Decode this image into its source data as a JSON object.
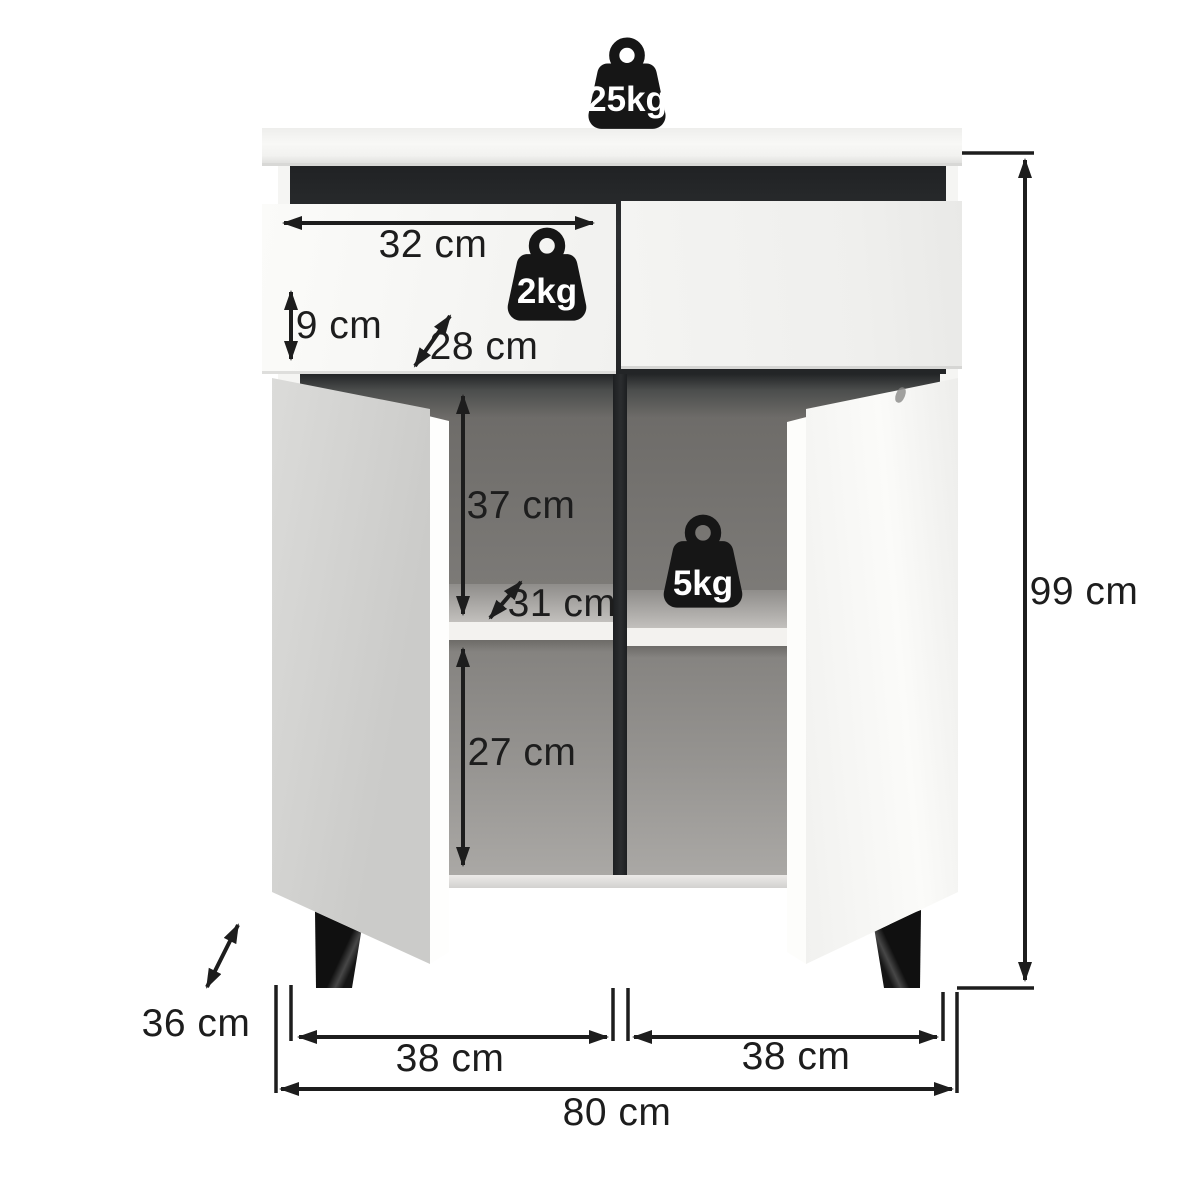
{
  "capacities": {
    "top": "25kg",
    "drawer": "2kg",
    "shelf": "5kg"
  },
  "dims": {
    "drawer_width": "32 cm",
    "drawer_height": "9 cm",
    "drawer_depth": "28 cm",
    "upper_compartment": "37 cm",
    "shelf_depth": "31 cm",
    "lower_compartment": "27 cm",
    "height": "99 cm",
    "depth": "36 cm",
    "left_door": "38 cm",
    "right_door": "38 cm",
    "width": "80 cm"
  },
  "colors": {
    "background": "#ffffff",
    "cabinet_white": "#f5f5f3",
    "accent_dark": "#242628",
    "interior_gray": "#7a7876",
    "dimension_ink": "#1d1d1d"
  }
}
